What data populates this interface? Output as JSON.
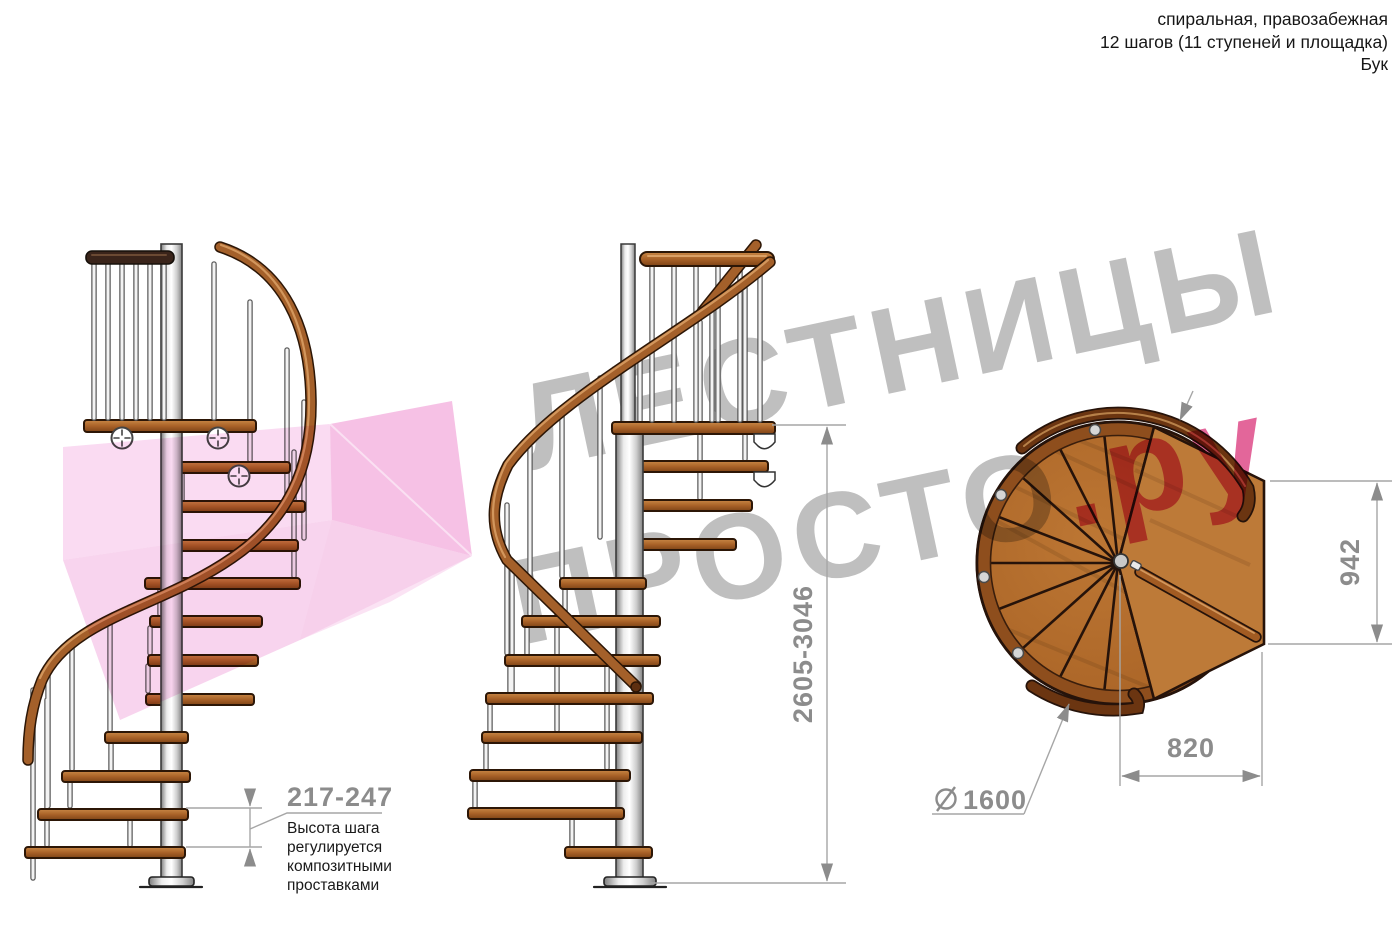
{
  "header": {
    "line1": "спиральная, правозабежная",
    "line2": "12 шагов (11 ступеней и площадка)",
    "line3": "Бук"
  },
  "watermark": {
    "title": "ЛЕСТНИЦЫ",
    "brand_gray": "ПРОСТО",
    "brand_pink": ".ру",
    "text_color": "#b8b8b8",
    "pink_color": "#e0558f",
    "arrow_color": "#ef94d2"
  },
  "dimensions": {
    "step_height": {
      "value": "217-247",
      "note_lines": [
        "Высота шага",
        "регулируется",
        "композитными",
        "проставками"
      ]
    },
    "total_height": {
      "value": "2605-3046"
    },
    "landing_depth": {
      "value": "942"
    },
    "landing_width": {
      "value": "820"
    },
    "diameter": {
      "symbol": "⌀",
      "value": "1600"
    }
  },
  "colors": {
    "wood": "#a96228",
    "handrail_dark": "#6b3511",
    "steel": "#d9d9d9",
    "dimension_lines": "#a6a6a6",
    "dimension_text": "#8c8c8c"
  }
}
